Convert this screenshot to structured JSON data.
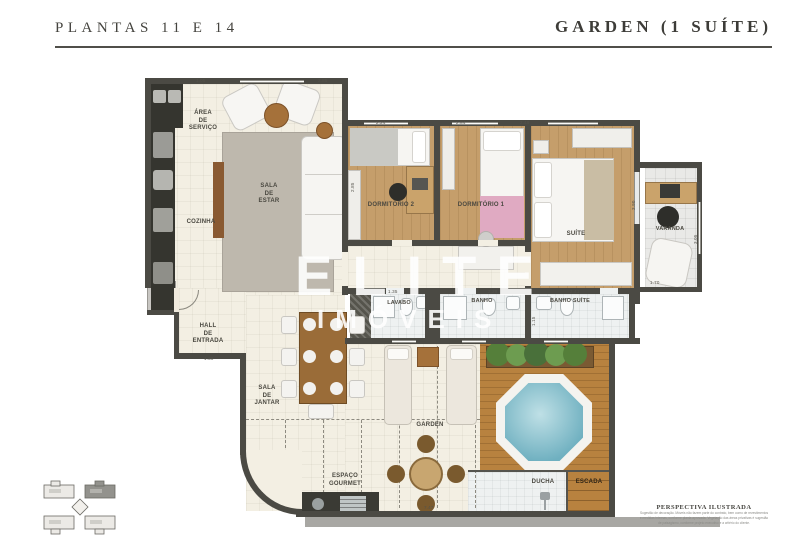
{
  "header": {
    "left_title": "PLANTAS 11 E 14",
    "right_title": "GARDEN (1 SUÍTE)"
  },
  "watermark": {
    "line1": "ELITE",
    "line2": "IMÓVEIS"
  },
  "rooms": {
    "area_servico": "ÁREA\nDE\nSERVIÇO",
    "cozinha": "COZINHA",
    "sala_estar": "SALA\nDE\nESTAR",
    "dormitorio2": "DORMITÓRIO 2",
    "dormitorio1": "DORMITÓRIO 1",
    "suite": "SUÍTE",
    "varanda": "VARANDA",
    "hall": "HALL\nDE\nENTRADA",
    "sala_jantar": "SALA\nDE\nJANTAR",
    "lavabo": "LAVABO",
    "banho": "BANHO",
    "banho_suite": "BANHO SUÍTE",
    "garden": "GARDEN",
    "espaco_gourmet": "ESPAÇO\nGOURMET",
    "ducha": "DUCHA",
    "escada": "ESCADA"
  },
  "dims": {
    "d105": "1.05",
    "d285a": "2.85",
    "d224": "2.24",
    "d284": "2.84",
    "d249": "2.49",
    "d285b": "2.85",
    "d390": "3.90",
    "d305": "3.05",
    "d170": "1.70",
    "d135": "1.35",
    "d228": "2.28",
    "d241": "2.41",
    "d115": "1.15",
    "d130": "1.30",
    "d747": "7.47"
  },
  "footer": {
    "title": "PERSPECTIVA ILUSTRADA",
    "line1": "Sugestão de decoração. Móveis não fazem parte do contrato, bem como de revestimentos",
    "line2": "e medidas internas, conforme planta aprovada. Vegetação das áreas privativas é sugestão",
    "line3": "de paisagismo, conforme projeto executivo e a critério do cliente."
  },
  "colors": {
    "wall": "#4b4a44",
    "floor_cream": "#f3efe3",
    "wood": "#c59e6b",
    "deck": "#b8823f",
    "water": "#8ec6d4",
    "title_text": "#45443f"
  }
}
